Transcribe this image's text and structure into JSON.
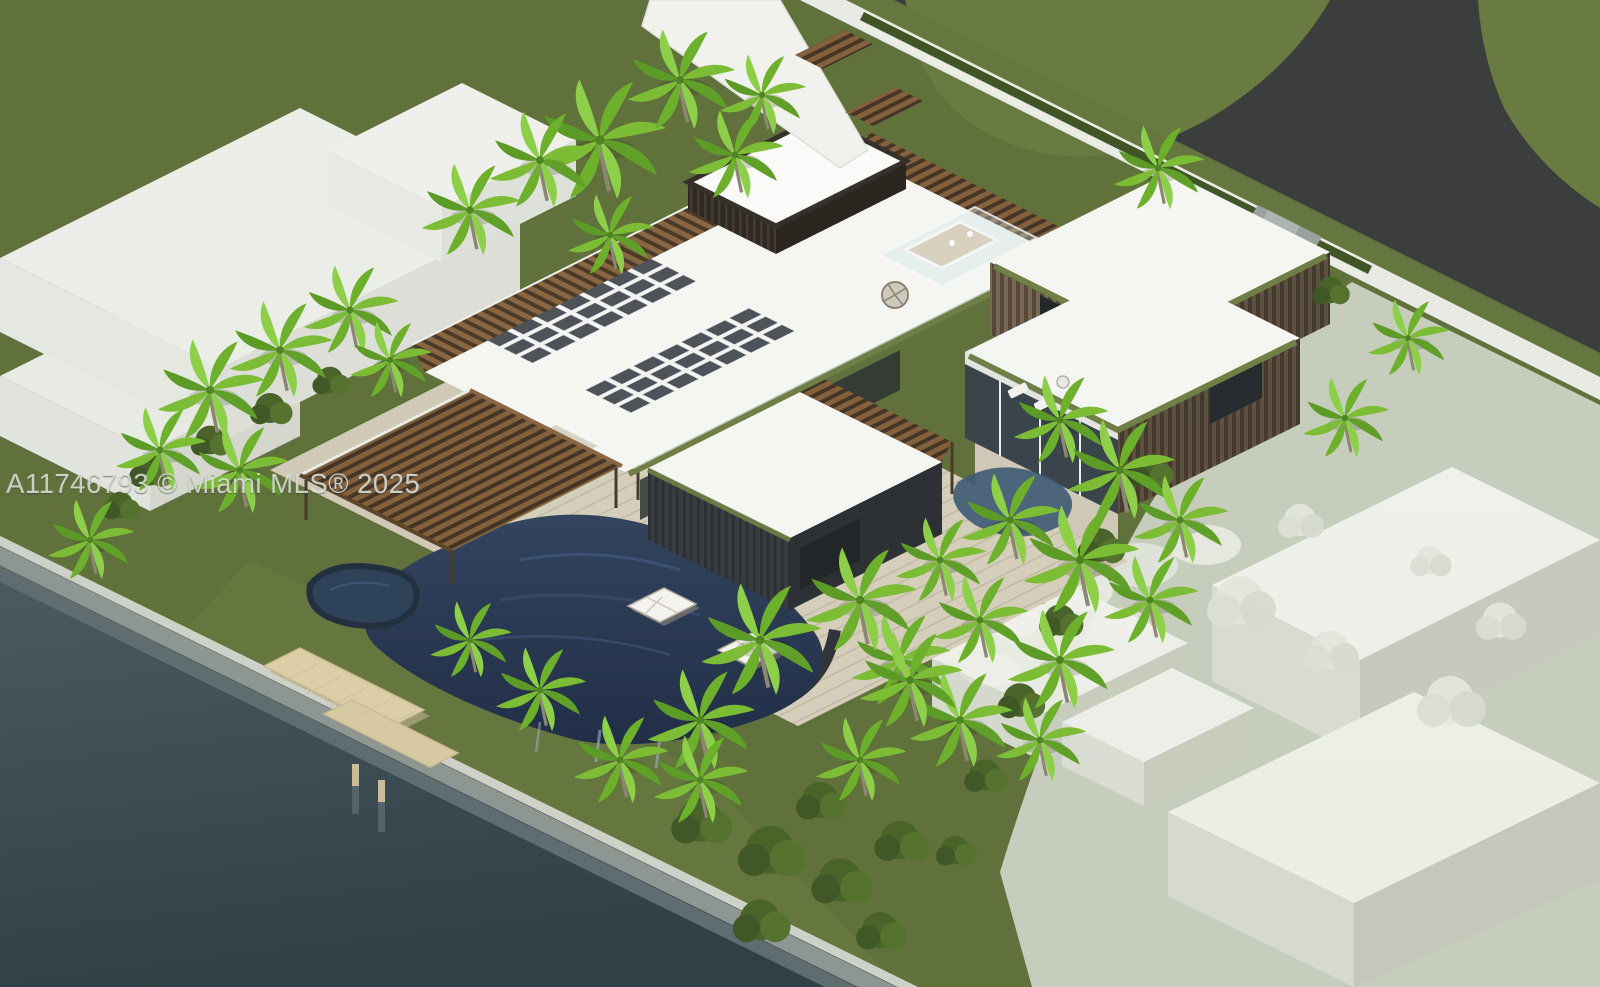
{
  "watermark": {
    "text": "A11746793 © Miami MLS® 2025"
  },
  "palette": {
    "lawn": "#61713c",
    "far_lawn": "#6a7b42",
    "road_asphalt": "#3b3e3c",
    "sidewalk": "#e9eae5",
    "water_near": "#4b5d63",
    "water_far": "#313f46",
    "seawall_gray": "#8e9691",
    "dock_wood": "#dccfa8",
    "roof_white": "#f5f5f2",
    "solar_panel": "#4d5359",
    "pergola_wood": "#8a6743",
    "slat_wall_wood": "#6d5e49",
    "dark_stone_wall": "#33363a",
    "green_roof": "#6f7f45",
    "pool_water": "#2c3c54",
    "stone_deck": "#d5cebb",
    "palm_green": "#7cbd35",
    "ghost_ground": "#c7cdbd",
    "ghost_building": "#f1f2ec"
  }
}
